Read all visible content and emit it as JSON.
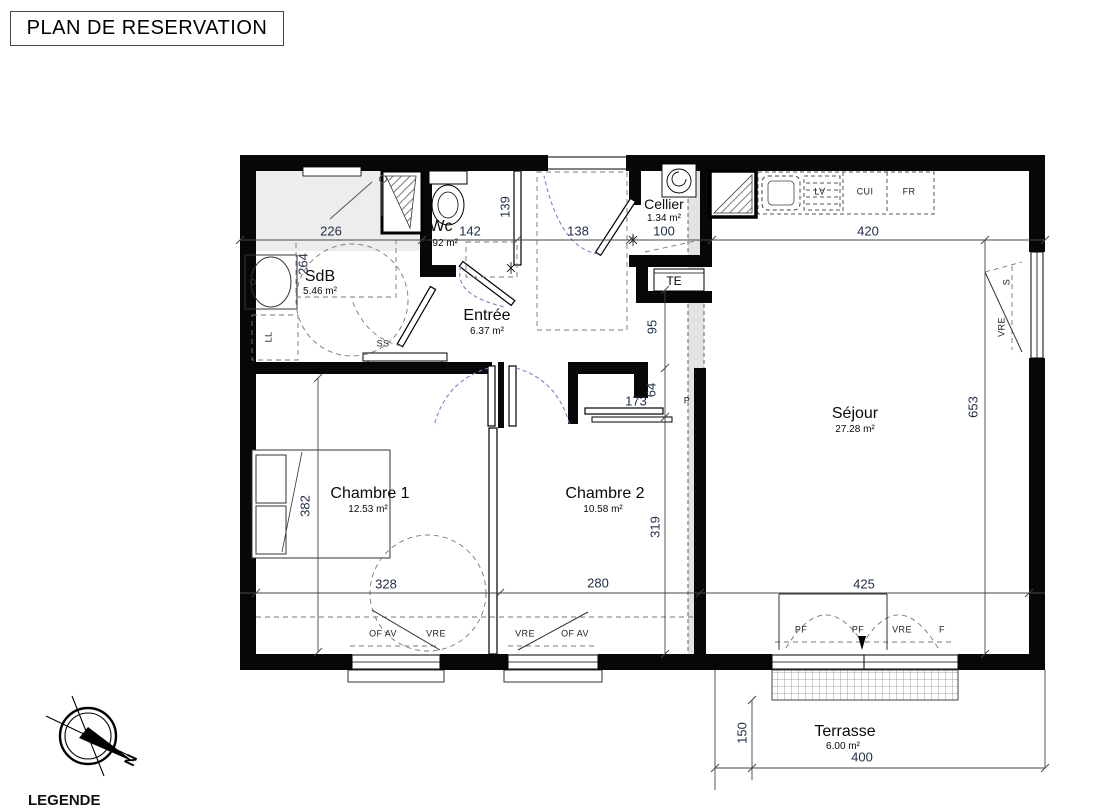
{
  "title": "PLAN DE RESERVATION",
  "legend": "LEGENDE",
  "compass": {
    "north": "N"
  },
  "rooms": {
    "sdb": {
      "name": "SdB",
      "area": "5.46 m²"
    },
    "wc": {
      "name": "Wc",
      "area": "1.92 m²"
    },
    "entree": {
      "name": "Entrée",
      "area": "6.37 m²"
    },
    "cellier": {
      "name": "Cellier",
      "area": "1.34 m²"
    },
    "sejour": {
      "name": "Séjour",
      "area": "27.28 m²"
    },
    "chambre1": {
      "name": "Chambre 1",
      "area": "12.53 m²"
    },
    "chambre2": {
      "name": "Chambre 2",
      "area": "10.58 m²"
    },
    "terrasse": {
      "name": "Terrasse",
      "area": "6.00 m²"
    }
  },
  "dims": {
    "sdb_w": "226",
    "wc_w": "142",
    "wc_h": "139",
    "entree_door": "138",
    "cellier_w": "100",
    "kitchen_w": "420",
    "sdb_h": "264",
    "hall_h": "95",
    "stub_h": "64",
    "ch2_door": "173",
    "ch2_h": "319",
    "sejour_h": "653",
    "bed_h": "382",
    "ch1_w": "328",
    "ch2_w": "280",
    "sejour_w": "425",
    "terrasse_h": "150",
    "terrasse_w": "400"
  },
  "equipment": {
    "ll": "LL",
    "ss": "SS",
    "te": "TE",
    "lv": "LV",
    "cui": "CUI",
    "fr": "FR",
    "p": "P",
    "s": "S",
    "vre": "VRE",
    "of_av": "OF AV",
    "pf": "PF",
    "f": "F"
  }
}
